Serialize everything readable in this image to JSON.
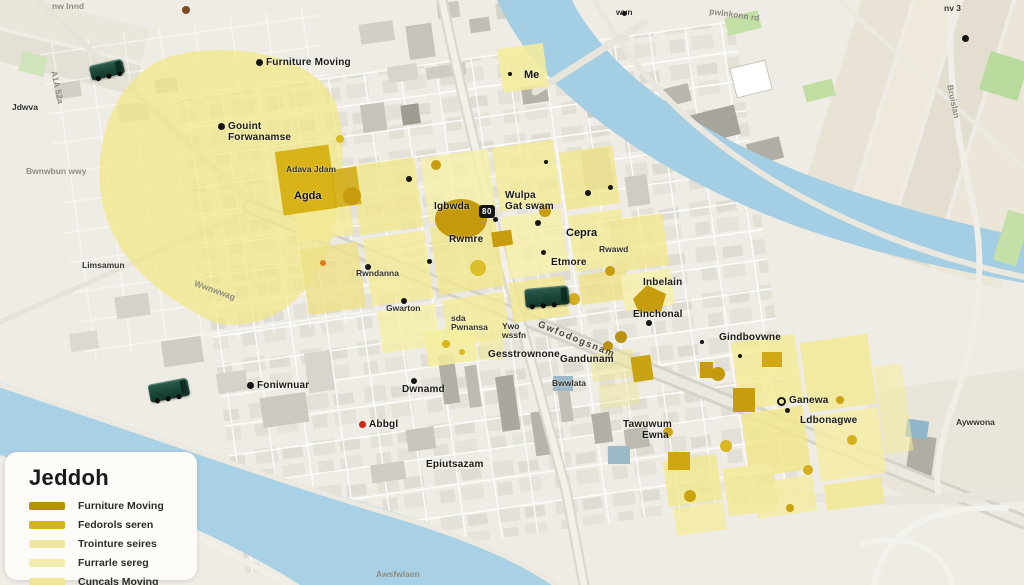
{
  "legend": {
    "title": "Jeddoh",
    "items": [
      {
        "label": "Furniture Moving",
        "color": "#b5920e"
      },
      {
        "label": "Fedorols seren",
        "color": "#d4b322"
      },
      {
        "label": "Trointure seires",
        "color": "#f0e8a4"
      },
      {
        "label": "Furrarle sereg",
        "color": "#f2eaae"
      },
      {
        "label": "Cuncals Moving",
        "color": "#eee49a"
      }
    ]
  },
  "map": {
    "shield": "80",
    "colors": {
      "water": "#a4cee3",
      "zone_pale": "#f4eb97",
      "zone_gold": "#c79d0e",
      "truck_green": "#1b4a3c",
      "marker_red": "#cf2318",
      "park_green": "#c2dfa4"
    },
    "labels": [
      {
        "t": "Furniture Moving",
        "x": 256,
        "y": 58,
        "c": "poi",
        "i": "dot"
      },
      {
        "t": "Gouint\nForwanamse",
        "x": 218,
        "y": 122,
        "c": "poi",
        "i": "dot"
      },
      {
        "t": "Bwnwbun wwy",
        "x": 26,
        "y": 167,
        "c": "road-gray"
      },
      {
        "t": "Limsamun",
        "x": 82,
        "y": 261,
        "c": "small-dark"
      },
      {
        "t": "Wwnwwag",
        "x": 196,
        "y": 279,
        "c": "road-gray",
        "r": 20
      },
      {
        "t": "Foniwnuar",
        "x": 247,
        "y": 381,
        "c": "poi",
        "i": "dot"
      },
      {
        "t": "Adava Jdam",
        "x": 286,
        "y": 165,
        "c": "small-dark"
      },
      {
        "t": "Agda",
        "x": 294,
        "y": 191,
        "c": "poi-bold"
      },
      {
        "t": "Rwndanna",
        "x": 356,
        "y": 269,
        "c": "small-dark"
      },
      {
        "t": "Gwarton",
        "x": 386,
        "y": 304,
        "c": "small-dark"
      },
      {
        "t": "Igbwda",
        "x": 434,
        "y": 202,
        "c": "poi"
      },
      {
        "t": "Rwmre",
        "x": 449,
        "y": 235,
        "c": "poi"
      },
      {
        "t": "Wulpa\nGat swam",
        "x": 505,
        "y": 191,
        "c": "poi"
      },
      {
        "t": "Cepra",
        "x": 566,
        "y": 228,
        "c": "poi-bold"
      },
      {
        "t": "Rwawd",
        "x": 599,
        "y": 245,
        "c": "small-dark"
      },
      {
        "t": "Etmore",
        "x": 551,
        "y": 258,
        "c": "poi"
      },
      {
        "t": "Inbelain",
        "x": 643,
        "y": 278,
        "c": "poi"
      },
      {
        "t": "Einchonal",
        "x": 633,
        "y": 310,
        "c": "poi"
      },
      {
        "t": "Gindbovwne",
        "x": 719,
        "y": 333,
        "c": "poi"
      },
      {
        "t": "Gesstrownone",
        "x": 488,
        "y": 350,
        "c": "poi"
      },
      {
        "t": "sda\nPwnansa",
        "x": 451,
        "y": 314,
        "c": "small-dark"
      },
      {
        "t": "Ywo\nwssfn",
        "x": 502,
        "y": 322,
        "c": "small-dark"
      },
      {
        "t": "Gandunam",
        "x": 560,
        "y": 355,
        "c": "poi"
      },
      {
        "t": "Bwwlata",
        "x": 552,
        "y": 379,
        "c": "small-dark"
      },
      {
        "t": "Dwnamd",
        "x": 402,
        "y": 385,
        "c": "poi"
      },
      {
        "t": "Abbgl",
        "x": 359,
        "y": 420,
        "c": "poi",
        "i": "red"
      },
      {
        "t": "Epiutsazam",
        "x": 426,
        "y": 460,
        "c": "poi"
      },
      {
        "t": "Tawuwum",
        "x": 623,
        "y": 420,
        "c": "poi"
      },
      {
        "t": "Ewna",
        "x": 642,
        "y": 431,
        "c": "poi"
      },
      {
        "t": "Ganewa",
        "x": 777,
        "y": 396,
        "c": "poi",
        "i": "ring"
      },
      {
        "t": "Ldbonagwe",
        "x": 800,
        "y": 416,
        "c": "poi"
      },
      {
        "t": "Aywwona",
        "x": 956,
        "y": 418,
        "c": "small-dark"
      },
      {
        "t": "Bruislan",
        "x": 954,
        "y": 84,
        "c": "road-gray",
        "r": 78
      },
      {
        "t": "pwlnkonn rd",
        "x": 710,
        "y": 7,
        "c": "road-gray",
        "r": 8
      },
      {
        "t": "Me",
        "x": 524,
        "y": 70,
        "c": "poi-bold"
      },
      {
        "t": "Gwfodogsnam",
        "x": 540,
        "y": 320,
        "c": "road-dark",
        "r": 22
      },
      {
        "t": "Awsfwlaen",
        "x": 376,
        "y": 570,
        "c": "road-gray"
      },
      {
        "t": "A1A 52a",
        "x": 58,
        "y": 70,
        "c": "road-gray",
        "r": 78
      },
      {
        "t": "nw lnnd",
        "x": 52,
        "y": 2,
        "c": "road-gray"
      },
      {
        "t": "Jdwva",
        "x": 12,
        "y": 103,
        "c": "small-dark"
      },
      {
        "t": "wvn",
        "x": 616,
        "y": 8,
        "c": "small-dark"
      },
      {
        "t": "nv 3",
        "x": 944,
        "y": 4,
        "c": "small-dark"
      }
    ],
    "icon_dots": [
      {
        "x": 406,
        "y": 176,
        "s": 6
      },
      {
        "x": 493,
        "y": 217,
        "s": 5
      },
      {
        "x": 535,
        "y": 220,
        "s": 6
      },
      {
        "x": 541,
        "y": 250,
        "s": 5
      },
      {
        "x": 585,
        "y": 190,
        "s": 6
      },
      {
        "x": 608,
        "y": 185,
        "s": 5
      },
      {
        "x": 646,
        "y": 320,
        "s": 6
      },
      {
        "x": 411,
        "y": 378,
        "s": 6
      },
      {
        "x": 365,
        "y": 264,
        "s": 6
      },
      {
        "x": 401,
        "y": 298,
        "s": 6
      },
      {
        "x": 785,
        "y": 408,
        "s": 5
      },
      {
        "x": 962,
        "y": 35,
        "s": 7
      },
      {
        "x": 508,
        "y": 72,
        "s": 4
      },
      {
        "x": 427,
        "y": 259,
        "s": 5
      },
      {
        "x": 622,
        "y": 11,
        "s": 5
      },
      {
        "x": 182,
        "y": 6,
        "s": 8,
        "c": "#7c4a1e"
      },
      {
        "x": 320,
        "y": 260,
        "s": 6,
        "c": "#e07a1e"
      },
      {
        "x": 738,
        "y": 354,
        "s": 4
      },
      {
        "x": 700,
        "y": 340,
        "s": 4
      },
      {
        "x": 544,
        "y": 160,
        "s": 4
      }
    ],
    "trucks": [
      {
        "x": 90,
        "y": 62,
        "w": 34,
        "h": 15,
        "r": -13
      },
      {
        "x": 525,
        "y": 287,
        "w": 44,
        "h": 19,
        "r": -5
      },
      {
        "x": 149,
        "y": 381,
        "w": 40,
        "h": 18,
        "r": -11
      }
    ]
  }
}
